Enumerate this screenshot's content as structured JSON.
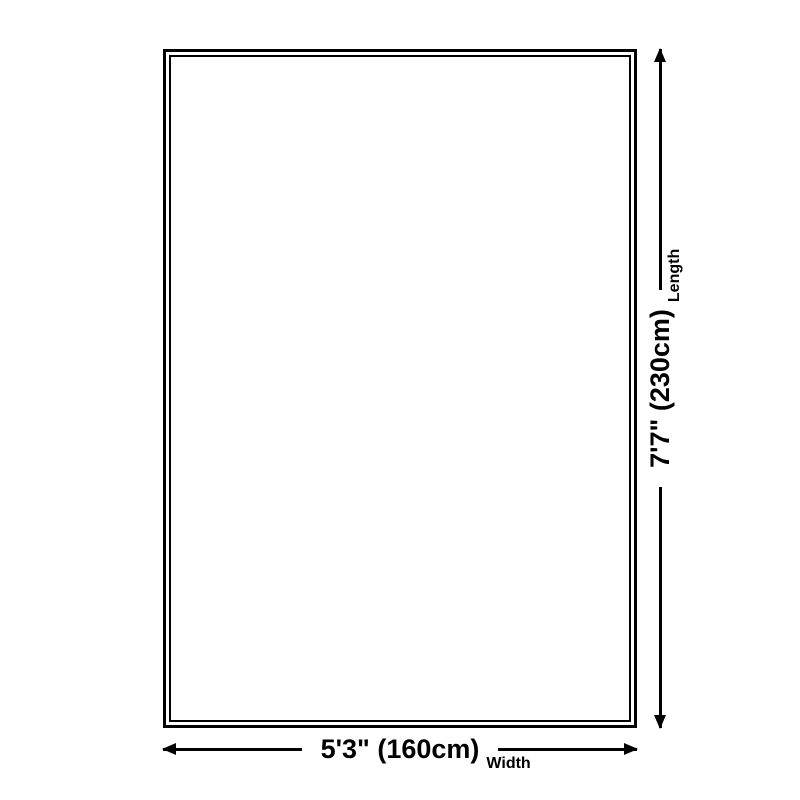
{
  "colors": {
    "foreground": "#000000",
    "background": "#ffffff"
  },
  "diagram": {
    "type": "product-size-diagram",
    "shape": "rectangle-double-outline",
    "width_dimension": {
      "value": "5'3\" (160cm)",
      "label": "Width"
    },
    "length_dimension": {
      "value": "7'7\" (230cm)",
      "label": "Length"
    }
  }
}
